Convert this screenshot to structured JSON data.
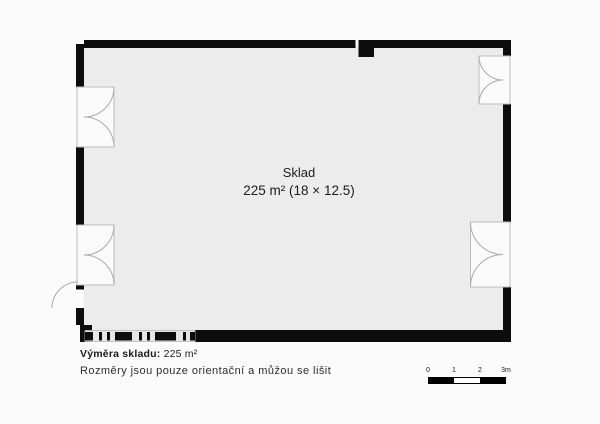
{
  "room": {
    "name": "Sklad",
    "dimensions": "225 m² (18 × 12.5)"
  },
  "footer": {
    "area_label": "Výměra skladu:",
    "area_value": "225 m²",
    "disclaimer": "Rozměry jsou pouze orientační a můžou se lišit"
  },
  "scale_bar": {
    "labels": [
      "0",
      "1",
      "2",
      "3m"
    ]
  },
  "colors": {
    "wall": "#0d0d0d",
    "room_fill": "#ececec",
    "door_fill": "#fafafa",
    "door_stroke": "#bdbdbd",
    "page_bg": "#fbfbfb"
  }
}
